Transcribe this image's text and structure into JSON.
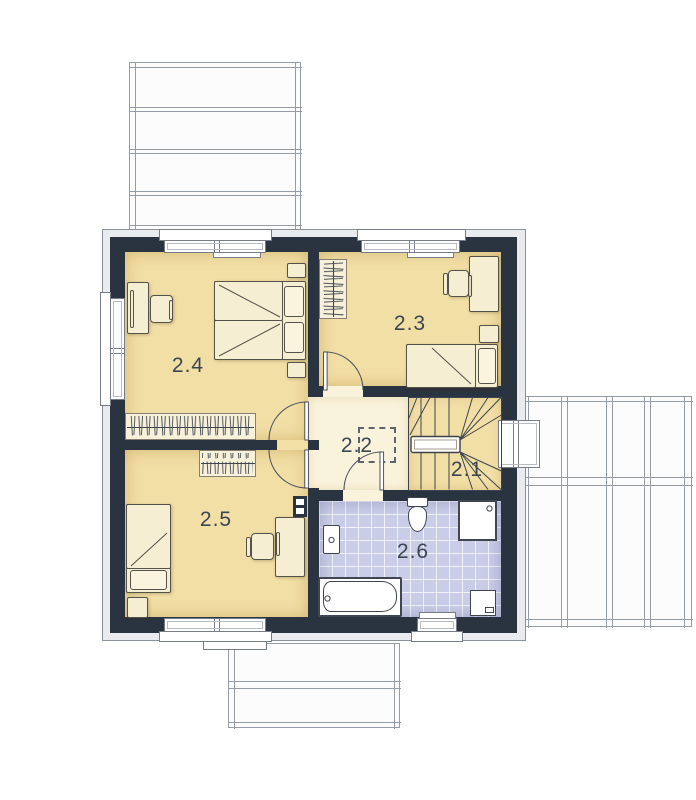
{
  "floor_plan": {
    "rooms": [
      {
        "label": "2.1",
        "name": "staircase"
      },
      {
        "label": "2.2",
        "name": "hallway"
      },
      {
        "label": "2.3",
        "name": "bedroom"
      },
      {
        "label": "2.4",
        "name": "bedroom"
      },
      {
        "label": "2.5",
        "name": "bedroom"
      },
      {
        "label": "2.6",
        "name": "bathroom"
      }
    ],
    "colors": {
      "wall": "#2A3440",
      "room_floor": "#F2DFA6",
      "hallway_floor": "#FAF3DC",
      "bathroom_tile": "#C9CDE7",
      "furniture": "#F6EED2",
      "facade_band": "#E9EBEE"
    }
  }
}
